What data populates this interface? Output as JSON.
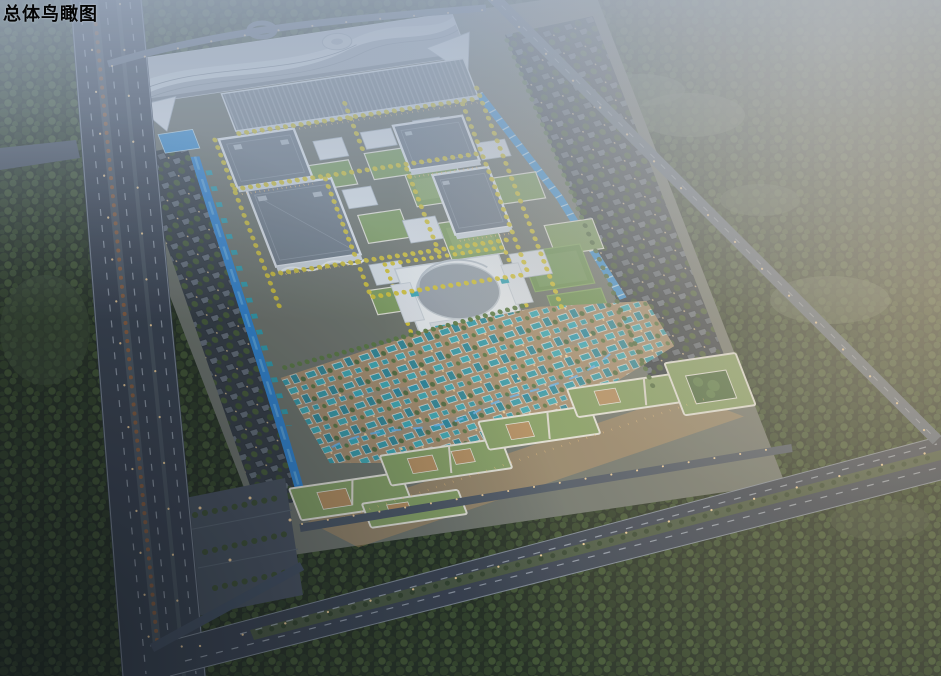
{
  "page": {
    "title": "总体鸟瞰图"
  },
  "scene": {
    "type": "architectural-aerial-rendering",
    "palette": {
      "haze_sky": "#a7b4c7",
      "forest_green": "#2e3c26",
      "road_asphalt": "#3a4250",
      "hall_roof_grey": "#707b86",
      "facade_white": "#e4e9ee",
      "green_roof": "#87a263",
      "gingko_yellow": "#d6c532",
      "village_teal": "#2e9fb0",
      "water_blue": "#2f86d6",
      "lamp_warm": "#ffd9a0"
    }
  }
}
